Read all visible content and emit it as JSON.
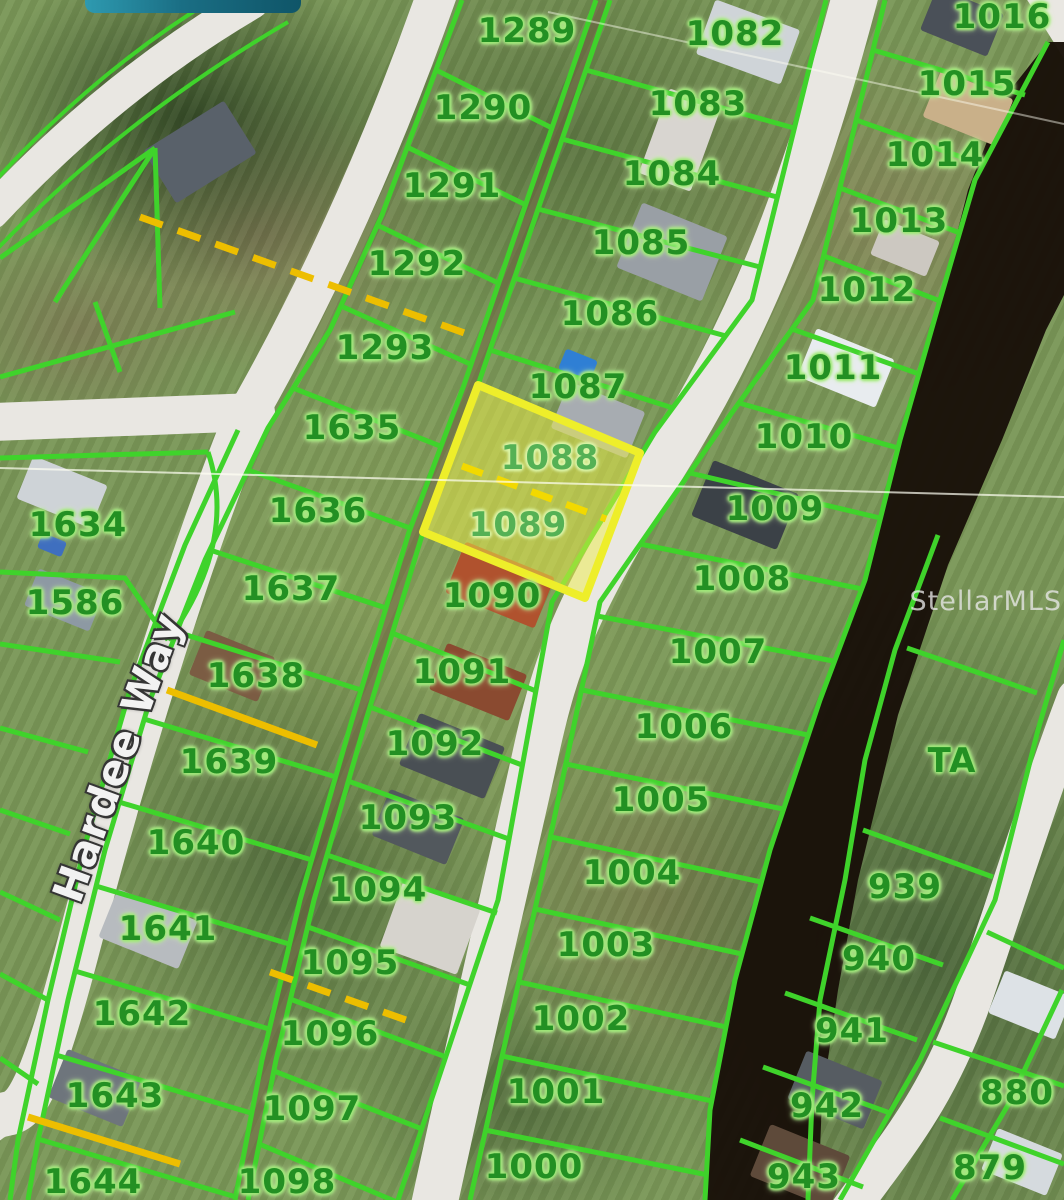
{
  "watermark": {
    "text": "StellarMLS"
  },
  "street_label": {
    "text": "Hardee Way"
  },
  "banner": {
    "description": "teal-pill-overlay"
  },
  "highlight": {
    "lot_numbers": [
      "1088",
      "1089"
    ],
    "fill": "rgba(238,238,72,0.5)",
    "outline": "#eeee2a"
  },
  "colors": {
    "parcel_line": "#3fd32b",
    "label_green": "#239023",
    "road": "#e9e7e2",
    "canal": "#191109",
    "utility_yellow": "#edbe00",
    "street_text": "#f2f2f2"
  },
  "lots": [
    {
      "n": "1289",
      "x": 527,
      "y": 31
    },
    {
      "n": "1290",
      "x": 483,
      "y": 108
    },
    {
      "n": "1291",
      "x": 452,
      "y": 186
    },
    {
      "n": "1292",
      "x": 417,
      "y": 264
    },
    {
      "n": "1293",
      "x": 385,
      "y": 348
    },
    {
      "n": "1635",
      "x": 352,
      "y": 428
    },
    {
      "n": "1636",
      "x": 318,
      "y": 511
    },
    {
      "n": "1637",
      "x": 291,
      "y": 589
    },
    {
      "n": "1638",
      "x": 256,
      "y": 676
    },
    {
      "n": "1639",
      "x": 229,
      "y": 762
    },
    {
      "n": "1640",
      "x": 196,
      "y": 843
    },
    {
      "n": "1641",
      "x": 168,
      "y": 929
    },
    {
      "n": "1642",
      "x": 142,
      "y": 1014
    },
    {
      "n": "1643",
      "x": 115,
      "y": 1096
    },
    {
      "n": "1644",
      "x": 93,
      "y": 1182
    },
    {
      "n": "1634",
      "x": 78,
      "y": 525
    },
    {
      "n": "1586",
      "x": 75,
      "y": 603
    },
    {
      "n": "1082",
      "x": 735,
      "y": 34
    },
    {
      "n": "1083",
      "x": 698,
      "y": 104
    },
    {
      "n": "1084",
      "x": 672,
      "y": 174
    },
    {
      "n": "1085",
      "x": 641,
      "y": 243
    },
    {
      "n": "1086",
      "x": 610,
      "y": 314
    },
    {
      "n": "1087",
      "x": 578,
      "y": 387
    },
    {
      "n": "1088",
      "x": 550,
      "y": 458,
      "hl": true
    },
    {
      "n": "1089",
      "x": 518,
      "y": 525,
      "hl": true
    },
    {
      "n": "1090",
      "x": 492,
      "y": 596
    },
    {
      "n": "1091",
      "x": 462,
      "y": 672
    },
    {
      "n": "1092",
      "x": 435,
      "y": 744
    },
    {
      "n": "1093",
      "x": 408,
      "y": 818
    },
    {
      "n": "1094",
      "x": 378,
      "y": 890
    },
    {
      "n": "1095",
      "x": 350,
      "y": 963
    },
    {
      "n": "1096",
      "x": 330,
      "y": 1034
    },
    {
      "n": "1097",
      "x": 312,
      "y": 1109
    },
    {
      "n": "1098",
      "x": 287,
      "y": 1182
    },
    {
      "n": "1016",
      "x": 1002,
      "y": 17
    },
    {
      "n": "1015",
      "x": 967,
      "y": 84
    },
    {
      "n": "1014",
      "x": 935,
      "y": 155
    },
    {
      "n": "1013",
      "x": 899,
      "y": 221
    },
    {
      "n": "1012",
      "x": 867,
      "y": 290
    },
    {
      "n": "1011",
      "x": 833,
      "y": 368
    },
    {
      "n": "1010",
      "x": 804,
      "y": 437
    },
    {
      "n": "1009",
      "x": 775,
      "y": 509
    },
    {
      "n": "1008",
      "x": 742,
      "y": 579
    },
    {
      "n": "1007",
      "x": 718,
      "y": 652
    },
    {
      "n": "1006",
      "x": 684,
      "y": 727
    },
    {
      "n": "1005",
      "x": 661,
      "y": 800
    },
    {
      "n": "1004",
      "x": 632,
      "y": 873
    },
    {
      "n": "1003",
      "x": 606,
      "y": 945
    },
    {
      "n": "1002",
      "x": 581,
      "y": 1019
    },
    {
      "n": "1001",
      "x": 556,
      "y": 1092
    },
    {
      "n": "1000",
      "x": 534,
      "y": 1167
    },
    {
      "n": "TA",
      "x": 952,
      "y": 761
    },
    {
      "n": "939",
      "x": 905,
      "y": 887
    },
    {
      "n": "940",
      "x": 879,
      "y": 959
    },
    {
      "n": "941",
      "x": 852,
      "y": 1031
    },
    {
      "n": "942",
      "x": 827,
      "y": 1106
    },
    {
      "n": "943",
      "x": 804,
      "y": 1177
    },
    {
      "n": "880",
      "x": 1017,
      "y": 1093
    },
    {
      "n": "879",
      "x": 990,
      "y": 1168
    }
  ],
  "map": {
    "layers": [
      {
        "t": "path",
        "d": "M-8,212 Q112,84 252,2",
        "s": "#e9e7e2",
        "w": 34,
        "c": "r"
      },
      {
        "t": "path",
        "d": "M440,-15 Q360,215 250,410",
        "s": "#e9e7e2",
        "w": 40,
        "c": "r"
      },
      {
        "t": "path",
        "d": "M-6,422 L256,412",
        "s": "#e9e7e2",
        "w": 38,
        "c": "r"
      },
      {
        "t": "path",
        "d": "M248,412 C196,540 132,740 78,948 S16,1098 -12,1122",
        "s": "#e9e7e2",
        "w": 44,
        "c": "r"
      },
      {
        "t": "path",
        "d": "M858,-15 C802,200 748,330 662,468 S556,660 536,752 S478,1002 432,1215",
        "s": "#e9e7e2",
        "w": 46,
        "c": "r"
      },
      {
        "t": "path",
        "d": "M1076,698 C1042,788 1014,878 976,990 S892,1150 846,1215",
        "s": "#e9e7e2",
        "w": 38,
        "c": "r"
      },
      {
        "t": "pg",
        "p": "1026,-2 1066,-2 1066,62",
        "f": "#e9e7e2"
      },
      {
        "t": "poly",
        "p": "603,0 529,215 471,385 416,532 359,720 307,900 269,1060 241,1200",
        "s": "#6d6040",
        "w": 13,
        "o": 0.5
      },
      {
        "t": "pg",
        "p": "1048,42 1004,98 968,190 940,300 902,440 867,575 822,700 772,850 737,980 712,1105 706,1200 818,1200 822,1100 838,990 858,880 898,715 948,565 1002,440 1046,330 1064,295 1064,42",
        "f": "#191109",
        "o": 0.97
      },
      {
        "t": "rect",
        "x": 200,
        "y": 152,
        "w": 95,
        "h": 62,
        "r": -32,
        "f": "#59616a"
      },
      {
        "t": "rect",
        "x": 62,
        "y": 492,
        "w": 80,
        "h": 46,
        "r": 22,
        "f": "#ced3d7"
      },
      {
        "t": "rect",
        "x": 52,
        "y": 545,
        "w": 26,
        "h": 16,
        "r": 22,
        "f": "#3f6fbf"
      },
      {
        "t": "rect",
        "x": 64,
        "y": 600,
        "w": 70,
        "h": 40,
        "r": 22,
        "f": "#8d99a3"
      },
      {
        "t": "rect",
        "x": 232,
        "y": 666,
        "w": 74,
        "h": 48,
        "r": 22,
        "f": "#7b5c43"
      },
      {
        "t": "rect",
        "x": 148,
        "y": 929,
        "w": 86,
        "h": 52,
        "r": 22,
        "f": "#b7bbbf"
      },
      {
        "t": "rect",
        "x": 95,
        "y": 1088,
        "w": 80,
        "h": 52,
        "r": 22,
        "f": "#6e757c"
      },
      {
        "t": "rect",
        "x": 672,
        "y": 252,
        "w": 92,
        "h": 70,
        "r": 22,
        "f": "#999fa5"
      },
      {
        "t": "rect",
        "x": 680,
        "y": 140,
        "w": 55,
        "h": 90,
        "r": 20,
        "f": "#d8d5d0"
      },
      {
        "t": "rect",
        "x": 748,
        "y": 42,
        "w": 90,
        "h": 58,
        "r": 20,
        "f": "#cfd4d8"
      },
      {
        "t": "rect",
        "x": 578,
        "y": 365,
        "w": 34,
        "h": 22,
        "r": 22,
        "f": "#2f7fd4"
      },
      {
        "t": "rect",
        "x": 598,
        "y": 420,
        "w": 82,
        "h": 50,
        "r": 22,
        "f": "#a7acb1"
      },
      {
        "t": "rect",
        "x": 962,
        "y": 22,
        "w": 72,
        "h": 46,
        "r": 22,
        "f": "#4a5058"
      },
      {
        "t": "rect",
        "x": 968,
        "y": 108,
        "w": 78,
        "h": 50,
        "r": 22,
        "f": "#c9b089"
      },
      {
        "t": "rect",
        "x": 905,
        "y": 248,
        "w": 60,
        "h": 38,
        "r": 22,
        "f": "#ccc8c1"
      },
      {
        "t": "rect",
        "x": 846,
        "y": 368,
        "w": 84,
        "h": 52,
        "r": 22,
        "f": "#e8ecef"
      },
      {
        "t": "rect",
        "x": 745,
        "y": 505,
        "w": 92,
        "h": 60,
        "r": 22,
        "f": "#3b4147"
      },
      {
        "t": "rect",
        "x": 500,
        "y": 585,
        "w": 96,
        "h": 55,
        "r": 22,
        "f": "#b0522e"
      },
      {
        "t": "rect",
        "x": 478,
        "y": 682,
        "w": 86,
        "h": 50,
        "r": 22,
        "f": "#8a4a30"
      },
      {
        "t": "rect",
        "x": 452,
        "y": 756,
        "w": 92,
        "h": 56,
        "r": 22,
        "f": "#494f54"
      },
      {
        "t": "rect",
        "x": 418,
        "y": 827,
        "w": 80,
        "h": 50,
        "r": 22,
        "f": "#52585d"
      },
      {
        "t": "rect",
        "x": 430,
        "y": 928,
        "w": 82,
        "h": 70,
        "r": 20,
        "f": "#d6d3cd"
      },
      {
        "t": "rect",
        "x": 835,
        "y": 1090,
        "w": 82,
        "h": 52,
        "r": 22,
        "f": "#565c62"
      },
      {
        "t": "rect",
        "x": 800,
        "y": 1166,
        "w": 86,
        "h": 56,
        "r": 22,
        "f": "#5e4a3a"
      },
      {
        "t": "rect",
        "x": 1030,
        "y": 1005,
        "w": 72,
        "h": 46,
        "r": 22,
        "f": "#dde2e6"
      },
      {
        "t": "rect",
        "x": 1022,
        "y": 1162,
        "w": 70,
        "h": 45,
        "r": 22,
        "f": "#d5dade"
      },
      {
        "t": "path",
        "d": "M-6,182 Q104,62 232,-12",
        "s": "#3fd32b",
        "w": 4
      },
      {
        "t": "path",
        "d": "M-2,248 Q124,118 288,22",
        "s": "#3fd32b",
        "w": 4
      },
      {
        "t": "poly",
        "p": "155,148 0,258",
        "s": "#3fd32b",
        "w": 5
      },
      {
        "t": "poly",
        "p": "155,148 55,302",
        "s": "#3fd32b",
        "w": 5
      },
      {
        "t": "poly",
        "p": "155,148 160,308",
        "s": "#3fd32b",
        "w": 5
      },
      {
        "t": "poly",
        "p": "0,377 235,312",
        "s": "#3fd32b",
        "w": 5
      },
      {
        "t": "poly",
        "p": "95,302 120,372",
        "s": "#3fd32b",
        "w": 5
      },
      {
        "t": "poly",
        "p": "0,458 208,452",
        "s": "#3fd32b",
        "w": 5
      },
      {
        "t": "path",
        "d": "M208,452 Q238,542 168,640",
        "s": "#3fd32b",
        "w": 5
      },
      {
        "t": "poly",
        "p": "0,572 125,578 168,640",
        "s": "#3fd32b",
        "w": 5
      },
      {
        "t": "poly",
        "p": "0,644 120,662",
        "s": "#3fd32b",
        "w": 5
      },
      {
        "t": "poly",
        "p": "0,728 88,752",
        "s": "#3fd32b",
        "w": 5
      },
      {
        "t": "poly",
        "p": "0,810 70,834",
        "s": "#3fd32b",
        "w": 5
      },
      {
        "t": "poly",
        "p": "0,892 60,920",
        "s": "#3fd32b",
        "w": 5
      },
      {
        "t": "poly",
        "p": "0,974 48,1000",
        "s": "#3fd32b",
        "w": 5
      },
      {
        "t": "poly",
        "p": "0,1058 38,1084",
        "s": "#3fd32b",
        "w": 5
      },
      {
        "t": "poly",
        "p": "238,430 185,545 130,690 85,845 48,1000 18,1140 10,1200",
        "s": "#3fd32b",
        "w": 5
      },
      {
        "t": "poly",
        "p": "462,0 382,215 330,330 268,428 205,560 150,700 105,850 68,1000 38,1140 28,1200",
        "s": "#3fd32b",
        "w": 5
      },
      {
        "t": "poly",
        "p": "596,0 522,215 464,385 409,532 352,720 300,900 262,1060 235,1200",
        "s": "#3fd32b",
        "w": 5
      },
      {
        "t": "poly",
        "p": "436,70 552,128",
        "s": "#3fd32b",
        "w": 5
      },
      {
        "t": "poly",
        "p": "407,147 526,205",
        "s": "#3fd32b",
        "w": 5
      },
      {
        "t": "poly",
        "p": "377,225 498,283",
        "s": "#3fd32b",
        "w": 5
      },
      {
        "t": "poly",
        "p": "341,306 470,364",
        "s": "#3fd32b",
        "w": 5
      },
      {
        "t": "poly",
        "p": "293,388 440,446",
        "s": "#3fd32b",
        "w": 5
      },
      {
        "t": "poly",
        "p": "248,470 410,528",
        "s": "#3fd32b",
        "w": 5
      },
      {
        "t": "poly",
        "p": "210,550 386,608",
        "s": "#3fd32b",
        "w": 5
      },
      {
        "t": "poly",
        "p": "177,632 361,690",
        "s": "#3fd32b",
        "w": 5
      },
      {
        "t": "poly",
        "p": "144,719 336,777",
        "s": "#3fd32b",
        "w": 5
      },
      {
        "t": "poly",
        "p": "119,802 312,860",
        "s": "#3fd32b",
        "w": 5
      },
      {
        "t": "poly",
        "p": "96,886 289,944",
        "s": "#3fd32b",
        "w": 5
      },
      {
        "t": "poly",
        "p": "75,971 269,1029",
        "s": "#3fd32b",
        "w": 5
      },
      {
        "t": "poly",
        "p": "56,1055 251,1113",
        "s": "#3fd32b",
        "w": 5
      },
      {
        "t": "poly",
        "p": "38,1139 236,1197",
        "s": "#3fd32b",
        "w": 5
      },
      {
        "t": "poly",
        "p": "610,0 536,215 478,385 423,532 366,720 314,900 276,1060 248,1200",
        "s": "#3fd32b",
        "w": 5
      },
      {
        "t": "poly",
        "p": "826,0 752,300 655,432 552,602 498,900 398,1200",
        "s": "#3fd32b",
        "w": 5
      },
      {
        "t": "poly",
        "p": "586,70 794,128",
        "s": "#3fd32b",
        "w": 5
      },
      {
        "t": "poly",
        "p": "562,139 777,197",
        "s": "#3fd32b",
        "w": 5
      },
      {
        "t": "poly",
        "p": "538,209 760,267",
        "s": "#3fd32b",
        "w": 5
      },
      {
        "t": "poly",
        "p": "514,278 726,336",
        "s": "#3fd32b",
        "w": 5
      },
      {
        "t": "poly",
        "p": "490,350 673,408",
        "s": "#3fd32b",
        "w": 5
      },
      {
        "t": "poly",
        "p": "392,633 536,691",
        "s": "#3fd32b",
        "w": 5
      },
      {
        "t": "poly",
        "p": "370,707 522,765",
        "s": "#3fd32b",
        "w": 5
      },
      {
        "t": "poly",
        "p": "348,781 509,839",
        "s": "#3fd32b",
        "w": 5
      },
      {
        "t": "poly",
        "p": "327,855 497,913",
        "s": "#3fd32b",
        "w": 5
      },
      {
        "t": "poly",
        "p": "308,927 470,985",
        "s": "#3fd32b",
        "w": 5
      },
      {
        "t": "poly",
        "p": "290,999 446,1057",
        "s": "#3fd32b",
        "w": 5
      },
      {
        "t": "poly",
        "p": "274,1071 422,1129",
        "s": "#3fd32b",
        "w": 5
      },
      {
        "t": "poly",
        "p": "259,1144 397,1202",
        "s": "#3fd32b",
        "w": 5
      },
      {
        "t": "poly",
        "p": "885,0 813,300 718,432 600,602 537,900 470,1200",
        "s": "#3fd32b",
        "w": 5
      },
      {
        "t": "poly",
        "p": "1048,42 975,180 940,300 900,440 865,580 820,700 770,850 735,980 710,1110 705,1200",
        "s": "#3fd32b",
        "w": 5
      },
      {
        "t": "poly",
        "p": "873,50 1025,95",
        "s": "#3fd32b",
        "w": 5
      },
      {
        "t": "poly",
        "p": "856,120 984,165",
        "s": "#3fd32b",
        "w": 5
      },
      {
        "t": "poly",
        "p": "840,188 960,233",
        "s": "#3fd32b",
        "w": 5
      },
      {
        "t": "poly",
        "p": "824,256 940,301",
        "s": "#3fd32b",
        "w": 5
      },
      {
        "t": "poly",
        "p": "792,329 919,374",
        "s": "#3fd32b",
        "w": 5
      },
      {
        "t": "poly",
        "p": "739,403 898,448",
        "s": "#3fd32b",
        "w": 5
      },
      {
        "t": "poly",
        "p": "690,473 880,518",
        "s": "#3fd32b",
        "w": 5
      },
      {
        "t": "poly",
        "p": "640,544 862,589",
        "s": "#3fd32b",
        "w": 5
      },
      {
        "t": "poly",
        "p": "597,616 833,661",
        "s": "#3fd32b",
        "w": 5
      },
      {
        "t": "poly",
        "p": "582,690 808,735",
        "s": "#3fd32b",
        "w": 5
      },
      {
        "t": "poly",
        "p": "566,764 783,809",
        "s": "#3fd32b",
        "w": 5
      },
      {
        "t": "poly",
        "p": "551,837 761,882",
        "s": "#3fd32b",
        "w": 5
      },
      {
        "t": "poly",
        "p": "535,909 742,954",
        "s": "#3fd32b",
        "w": 5
      },
      {
        "t": "poly",
        "p": "519,982 726,1027",
        "s": "#3fd32b",
        "w": 5
      },
      {
        "t": "poly",
        "p": "502,1056 712,1101",
        "s": "#3fd32b",
        "w": 5
      },
      {
        "t": "poly",
        "p": "485,1130 708,1175",
        "s": "#3fd32b",
        "w": 5
      },
      {
        "t": "poly",
        "p": "938,535 895,650 865,760 845,880 820,1000 812,1100 808,1200",
        "s": "#3fd32b",
        "w": 5
      },
      {
        "t": "poly",
        "p": "1064,640 1038,730 995,900 920,1060 840,1200",
        "s": "#3fd32b",
        "w": 5
      },
      {
        "t": "poly",
        "p": "907,648 1037,693",
        "s": "#3fd32b",
        "w": 5
      },
      {
        "t": "poly",
        "p": "863,830 993,877",
        "s": "#3fd32b",
        "w": 5
      },
      {
        "t": "poly",
        "p": "810,918 943,965",
        "s": "#3fd32b",
        "w": 5
      },
      {
        "t": "poly",
        "p": "785,993 917,1040",
        "s": "#3fd32b",
        "w": 5
      },
      {
        "t": "poly",
        "p": "763,1067 890,1113",
        "s": "#3fd32b",
        "w": 5
      },
      {
        "t": "poly",
        "p": "740,1140 863,1187",
        "s": "#3fd32b",
        "w": 5
      },
      {
        "t": "poly",
        "p": "1062,990 1008,1105 952,1200",
        "s": "#3fd32b",
        "w": 5
      },
      {
        "t": "poly",
        "p": "987,932 1064,968",
        "s": "#3fd32b",
        "w": 5
      },
      {
        "t": "poly",
        "p": "933,1042 1064,1086",
        "s": "#3fd32b",
        "w": 5
      },
      {
        "t": "poly",
        "p": "940,1118 1064,1164",
        "s": "#3fd32b",
        "w": 5
      },
      {
        "t": "pg",
        "p": "478,385 640,453 585,598 423,532",
        "f": "rgba(238,238,72,0.5)",
        "s": "#eeee2a",
        "w": 8
      },
      {
        "t": "poly",
        "p": "140,217 470,335",
        "s": "#edbe00",
        "w": 7,
        "d2": "24 16"
      },
      {
        "t": "poly",
        "p": "462,466 606,519",
        "s": "#f2d900",
        "w": 7,
        "d2": "22 15"
      },
      {
        "t": "poly",
        "p": "167,690 317,745",
        "s": "#edbe00",
        "w": 7
      },
      {
        "t": "poly",
        "p": "270,972 420,1025",
        "s": "#edbe00",
        "w": 7,
        "d2": "24 16"
      },
      {
        "t": "poly",
        "p": "28,1117 180,1164",
        "s": "#edbe00",
        "w": 7
      },
      {
        "t": "poly",
        "p": "0,468 1064,497",
        "s": "rgba(255,255,244,0.7)",
        "w": 2
      },
      {
        "t": "poly",
        "p": "548,12 1064,124",
        "s": "rgba(255,255,244,0.45)",
        "w": 2
      }
    ]
  }
}
